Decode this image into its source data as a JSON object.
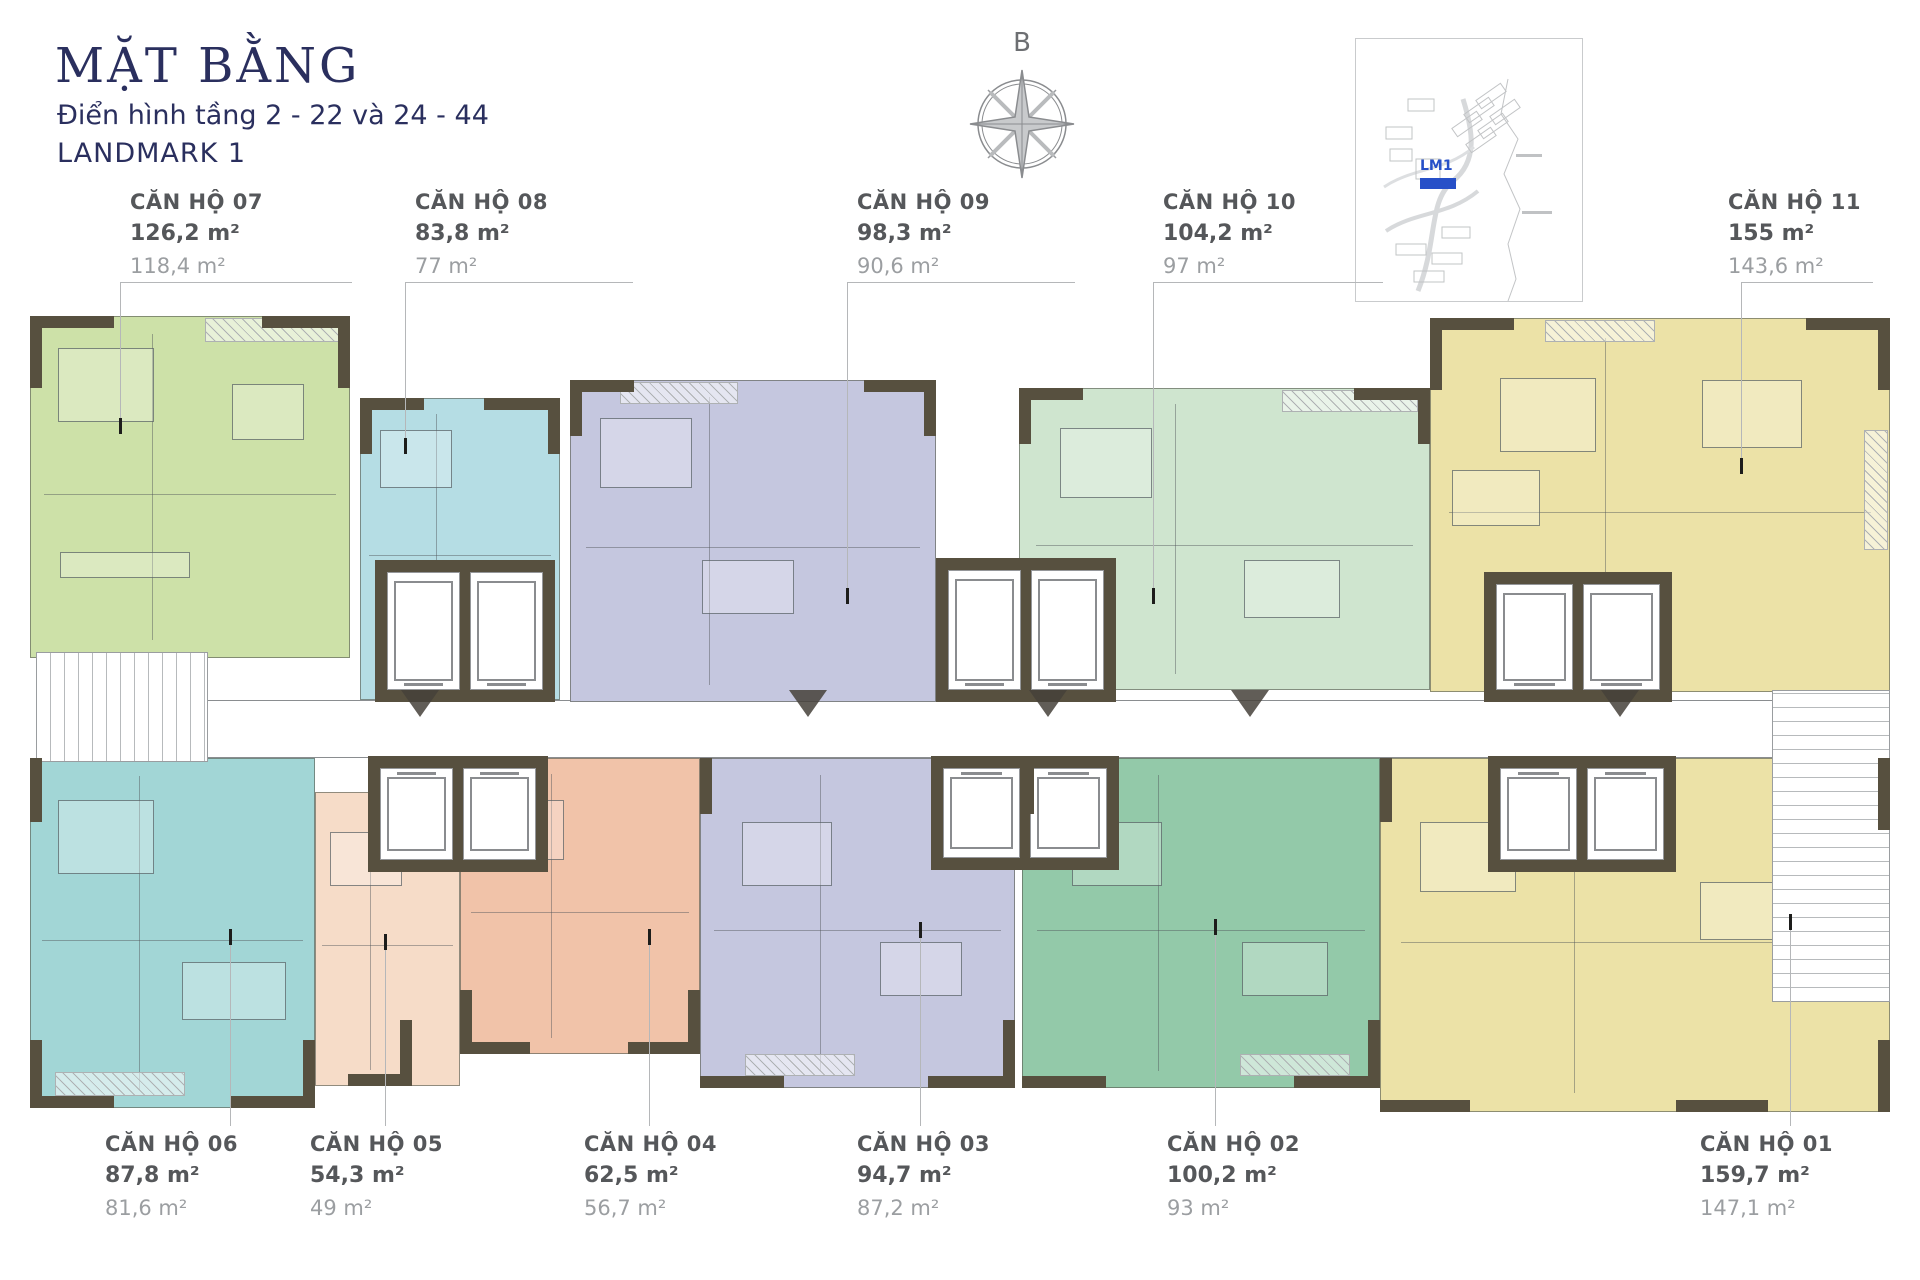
{
  "header": {
    "title": "MẶT BẰNG",
    "subtitle": "Điển hình tầng 2 - 22 và 24 - 44",
    "building": "LANDMARK 1"
  },
  "compass": {
    "north_label": "B"
  },
  "site_map": {
    "building_marker": "LM1"
  },
  "colors": {
    "title_navy": "#2a2f5e",
    "label_dark": "#55575a",
    "label_light": "#9b9ea1",
    "wall_brown": "#57503f",
    "marker_blue": "#2750c8",
    "leader_gray": "#b5b7b9"
  },
  "units": [
    {
      "no": "01",
      "name": "CĂN HỘ 01",
      "area_1": "159,7 m²",
      "area_2": "147,1 m²",
      "color": "#ece2a7"
    },
    {
      "no": "02",
      "name": "CĂN HỘ 02",
      "area_1": "100,2 m²",
      "area_2": "93 m²",
      "color": "#93c9a9"
    },
    {
      "no": "03",
      "name": "CĂN HỘ 03",
      "area_1": "94,7 m²",
      "area_2": "87,2 m²",
      "color": "#c5c7df"
    },
    {
      "no": "04",
      "name": "CĂN HỘ 04",
      "area_1": "62,5 m²",
      "area_2": "56,7 m²",
      "color": "#f1c3a9"
    },
    {
      "no": "05",
      "name": "CĂN HỘ 05",
      "area_1": "54,3 m²",
      "area_2": "49 m²",
      "color": "#f6dcc8"
    },
    {
      "no": "06",
      "name": "CĂN HỘ 06",
      "area_1": "87,8 m²",
      "area_2": "81,6 m²",
      "color": "#a2d6d6"
    },
    {
      "no": "07",
      "name": "CĂN HỘ 07",
      "area_1": "126,2 m²",
      "area_2": "118,4 m²",
      "color": "#cde1a8"
    },
    {
      "no": "08",
      "name": "CĂN HỘ 08",
      "area_1": "83,8 m²",
      "area_2": "77 m²",
      "color": "#b5dde4"
    },
    {
      "no": "09",
      "name": "CĂN HỘ 09",
      "area_1": "98,3 m²",
      "area_2": "90,6 m²",
      "color": "#c5c7df"
    },
    {
      "no": "10",
      "name": "CĂN HỘ 10",
      "area_1": "104,2 m²",
      "area_2": "97 m²",
      "color": "#cfe5cf"
    },
    {
      "no": "11",
      "name": "CĂN HỘ 11",
      "area_1": "155 m²",
      "area_2": "143,6 m²",
      "color": "#ece2a7"
    }
  ]
}
